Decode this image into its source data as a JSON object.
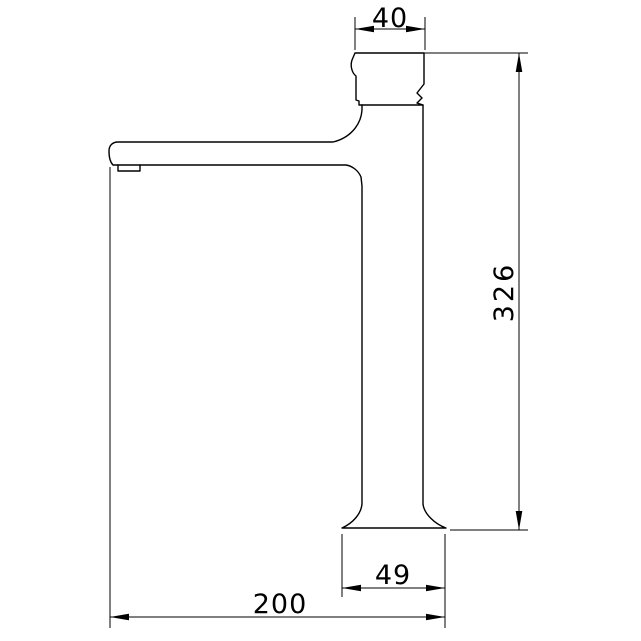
{
  "canvas": {
    "background": "#ffffff",
    "line_color": "#000000"
  },
  "drawing": {
    "type": "technical-dimension-drawing",
    "dimensions": {
      "top_width": "40",
      "overall_height": "326",
      "base_width": "49",
      "spout_reach": "200"
    }
  }
}
